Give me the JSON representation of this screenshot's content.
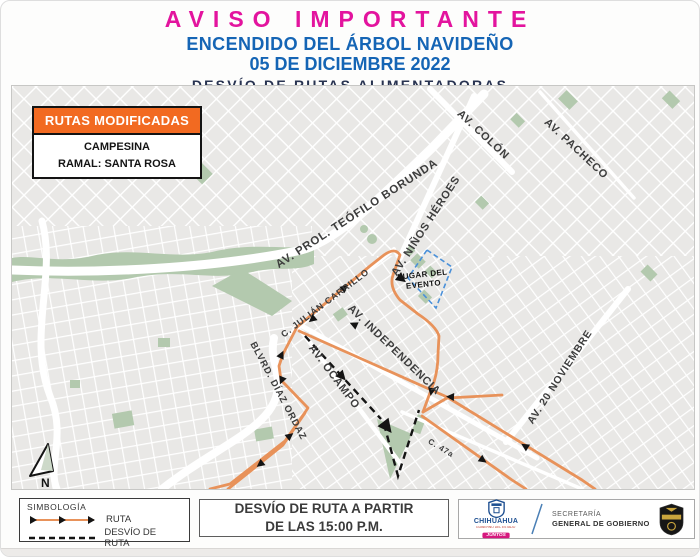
{
  "header": {
    "title": "AVISO IMPORTANTE",
    "line2": "ENCENDIDO DEL ÁRBOL NAVIDEÑO",
    "line3": "05 DE DICIEMBRE 2022",
    "line4": "DESVÍO DE RUTAS ALIMENTADORAS"
  },
  "map": {
    "routes_box": {
      "title": "RUTAS MODIFICADAS",
      "route": "CAMPESINA",
      "branch": "RAMAL: SANTA ROSA"
    },
    "street_labels": [
      {
        "text": "AV. COLÓN"
      },
      {
        "text": "AV. PACHECO"
      },
      {
        "text": "AV. PROL. TEÓFILO BORUNDA"
      },
      {
        "text": "AV. NIÑOS HÉROES"
      },
      {
        "text": "C. JULIÁN CARRILLO"
      },
      {
        "text": "AV. INDEPENDENCIA"
      },
      {
        "text": "AV. OCAMPO"
      },
      {
        "text": "BLVRD. DÍAZ ORDAZ"
      },
      {
        "text": "AV. 20 NOVIEMBRE"
      },
      {
        "text": "C. 47a"
      }
    ],
    "event_label": {
      "line1": "LUGAR DEL",
      "line2": "EVENTO"
    },
    "north_label": "N"
  },
  "legend": {
    "title": "SIMBOLOGÍA",
    "route_label": "RUTA",
    "detour_label": "DESVÍO DE RUTA"
  },
  "notice": {
    "line1": "DESVÍO DE RUTA A PARTIR",
    "line2": "DE LAS 15:00 P.M."
  },
  "footer": {
    "state": {
      "name": "CHIHUAHUA",
      "tagline": "GOBIERNO DEL ESTADO",
      "badge": "JUNTOS"
    },
    "secretary": {
      "line1": "SECRETARÍA",
      "line2": "GENERAL DE GOBIERNO"
    }
  },
  "colors": {
    "title_magenta": "#e3149e",
    "subtitle_blue": "#1565b5",
    "dark_navy": "#273250",
    "route_orange": "#e8925a",
    "box_orange": "#f26a21",
    "park_green": "#b3c9ae",
    "map_bg": "#e9e8e6",
    "event_outline": "#4a90d9",
    "detour_black": "#141414"
  }
}
